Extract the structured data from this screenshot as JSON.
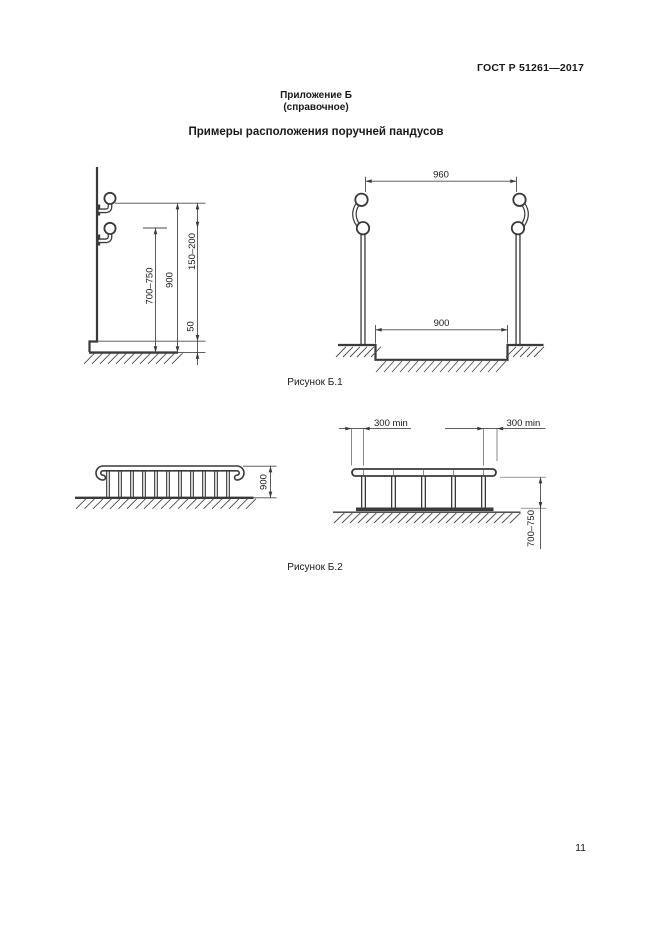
{
  "page": {
    "standard_number": "ГОСТ Р 51261—2017",
    "appendix_label": "Приложение Б",
    "appendix_type": "(справочное)",
    "title": "Примеры расположения поручней пандусов",
    "page_number": "11"
  },
  "colors": {
    "text": "#1a1a1a",
    "line": "#3a3a3a",
    "background": "#ffffff"
  },
  "figure_b1": {
    "caption": "Рисунок Б.1",
    "wall_drawing": {
      "height_lower_rail": "700–750",
      "height_upper_rail": "900",
      "rail_gap": "150–200",
      "curb_height": "50"
    },
    "posts_drawing": {
      "outer_width": "960",
      "clear_width": "900"
    }
  },
  "figure_b2": {
    "caption": "Рисунок Б.2",
    "baluster_drawing": {
      "rail_height": "900"
    },
    "posts_drawing": {
      "left_extension": "300 min",
      "right_extension": "300 min",
      "rail_height": "700–750"
    }
  }
}
